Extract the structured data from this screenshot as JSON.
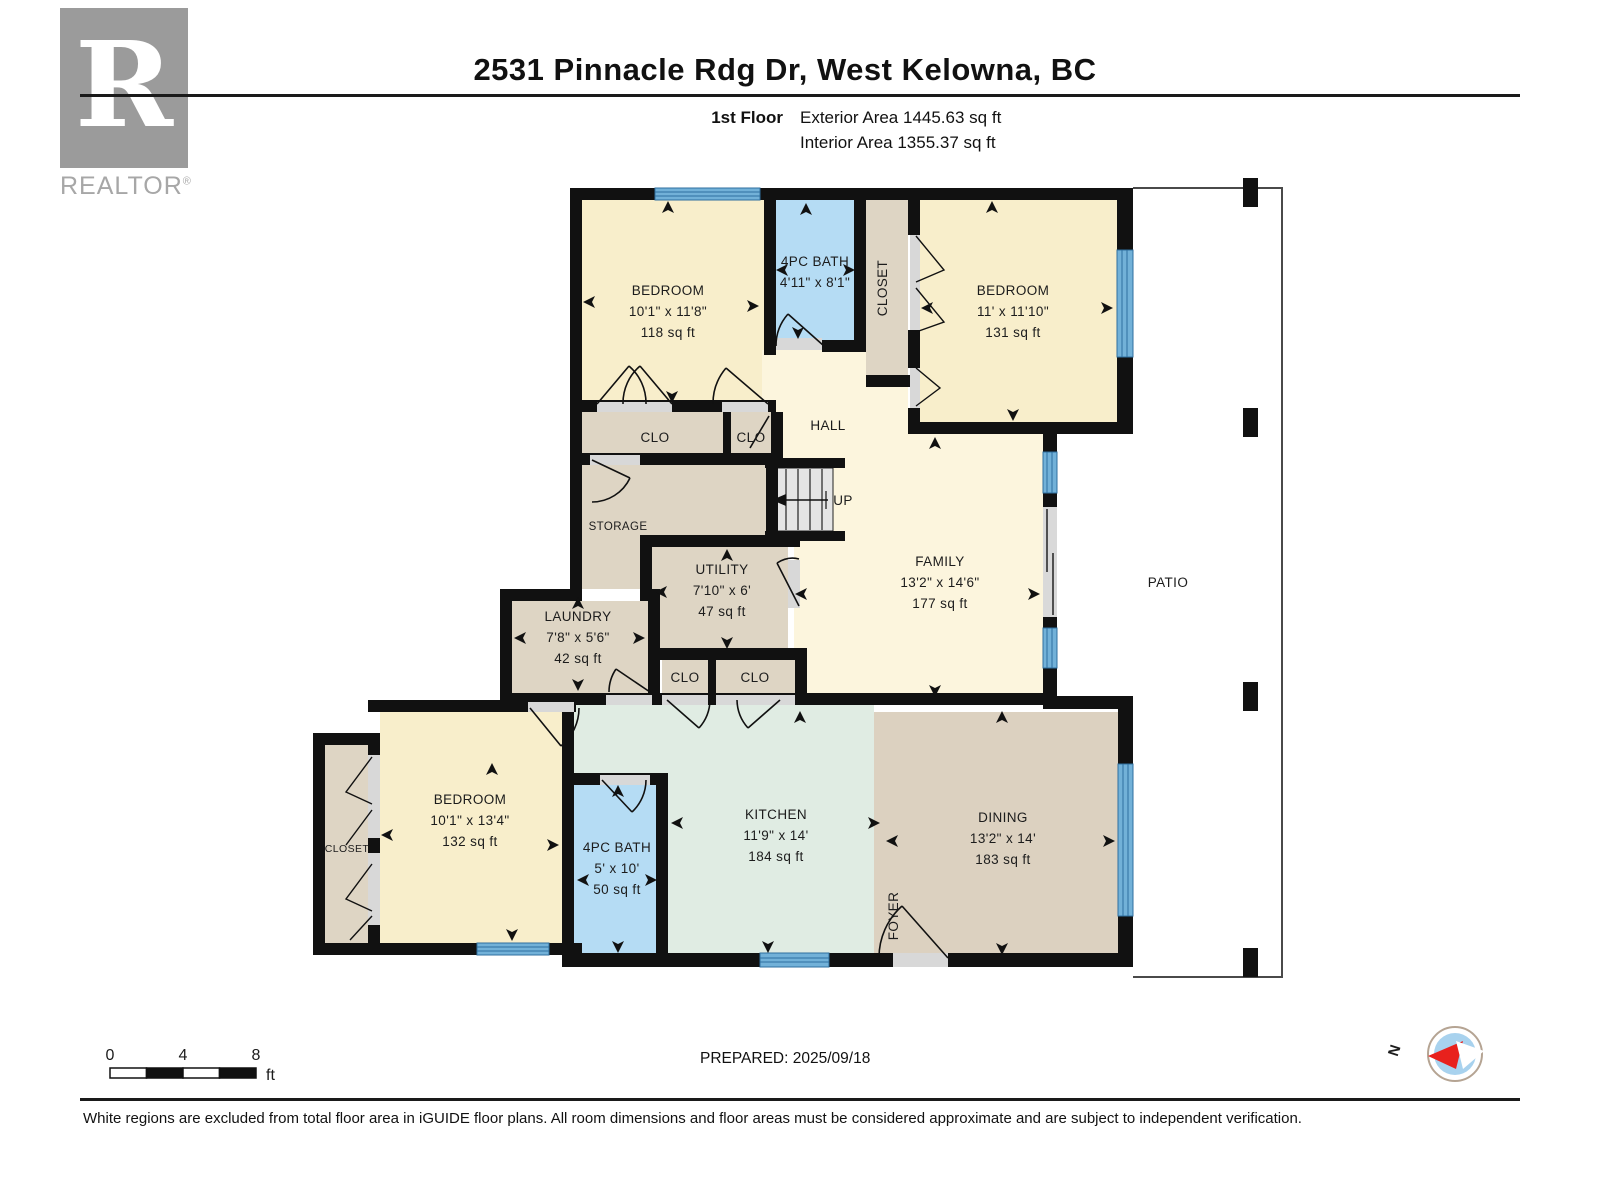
{
  "header": {
    "title": "2531 Pinnacle Rdg Dr, West Kelowna, BC",
    "floor_label": "1st Floor",
    "exterior_area": "Exterior Area 1445.63 sq ft",
    "interior_area": "Interior Area 1355.37 sq ft"
  },
  "branding": {
    "logo_letter": "R",
    "logo_text": "REALTOR",
    "registered_mark": "®"
  },
  "rooms": {
    "bedroom_top_left": {
      "name": "BEDROOM",
      "dims": "10'1\" x 11'8\"",
      "area": "118 sq ft"
    },
    "bath_top": {
      "name": "4PC BATH",
      "dims": "4'11\" x 8'1\""
    },
    "closet_top": {
      "name": "CLOSET"
    },
    "bedroom_top_right": {
      "name": "BEDROOM",
      "dims": "11' x 11'10\"",
      "area": "131 sq ft"
    },
    "hall": {
      "name": "HALL"
    },
    "clo_upper_left": {
      "name": "CLO"
    },
    "clo_upper_right": {
      "name": "CLO"
    },
    "storage": {
      "name": "STORAGE"
    },
    "stairs": {
      "name": "UP"
    },
    "utility": {
      "name": "UTILITY",
      "dims": "7'10\" x 6'",
      "area": "47 sq ft"
    },
    "laundry": {
      "name": "LAUNDRY",
      "dims": "7'8\" x 5'6\"",
      "area": "42 sq ft"
    },
    "family": {
      "name": "FAMILY",
      "dims": "13'2\" x 14'6\"",
      "area": "177 sq ft"
    },
    "patio": {
      "name": "PATIO"
    },
    "clo_lower_left": {
      "name": "CLO"
    },
    "clo_lower_right": {
      "name": "CLO"
    },
    "bedroom_lower": {
      "name": "BEDROOM",
      "dims": "10'1\" x 13'4\"",
      "area": "132 sq ft"
    },
    "closet_lower": {
      "name": "CLOSET"
    },
    "bath_lower": {
      "name": "4PC BATH",
      "dims": "5' x 10'",
      "area": "50 sq ft"
    },
    "kitchen": {
      "name": "KITCHEN",
      "dims": "11'9\" x 14'",
      "area": "184 sq ft"
    },
    "dining": {
      "name": "DINING",
      "dims": "13'2\" x 14'",
      "area": "183 sq ft"
    },
    "foyer": {
      "name": "FOYER"
    }
  },
  "scale_bar": {
    "labels": [
      "0",
      "4",
      "8"
    ],
    "unit": "ft"
  },
  "compass": {
    "north_label": "N"
  },
  "footer": {
    "prepared": "PREPARED: 2025/09/18",
    "disclaimer": "White regions are excluded from total floor area in iGUIDE floor plans. All room dimensions and floor areas must be considered approximate and are subject to independent verification."
  },
  "colors": {
    "room_cream": "#f8eecb",
    "room_cream_light": "#fcf5dd",
    "room_blue": "#b5dcf4",
    "room_tan": "#ded5c4",
    "room_tan_dark": "#dcd1c0",
    "room_mint": "#e0ece3",
    "wall": "#111111",
    "window_blue": "#72b1d8",
    "window_line": "#2f6f9f",
    "stairs_gray": "#e5e5e5",
    "compass_blue": "#a8d2ee",
    "compass_needle_red": "#e8211d"
  }
}
